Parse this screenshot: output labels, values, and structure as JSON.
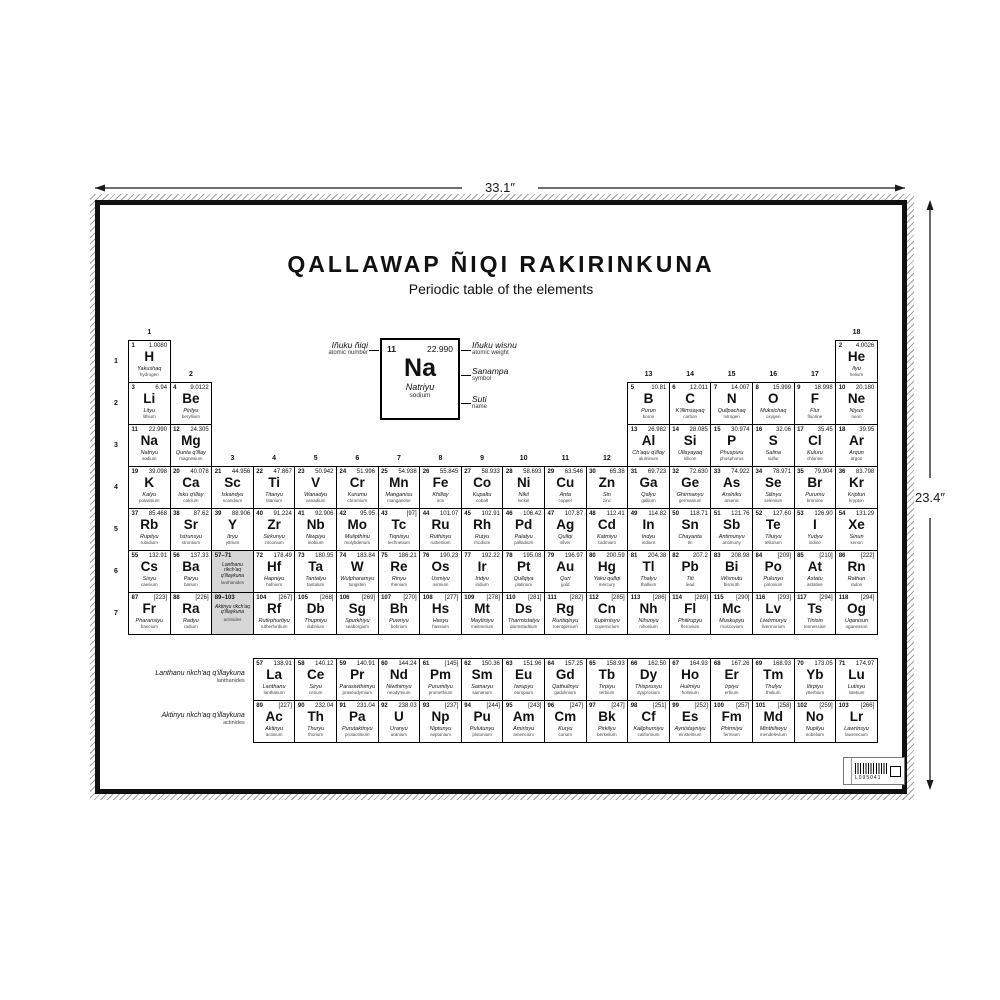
{
  "title": "QALLAWAP ÑIQI RAKIRINKUNA",
  "subtitle": "Periodic table of the elements",
  "dimensions": {
    "width": "33.1″",
    "height": "23.4″"
  },
  "legend": {
    "number": "11",
    "weight": "22.990",
    "symbol": "Na",
    "name": "Natriyu",
    "en": "sodium",
    "labels": {
      "number_qu": "Iñuku ñiqi",
      "number_en": "atomic number",
      "weight_qu": "Iñuku wisnu",
      "weight_en": "atomic weight",
      "symbol_qu": "Sanampa",
      "symbol_en": "symbol",
      "name_qu": "Suti",
      "name_en": "name"
    }
  },
  "table": {
    "period_labels": [
      "1",
      "2",
      "3",
      "4",
      "5",
      "6",
      "7"
    ],
    "group_labels": [
      {
        "t": "1",
        "c": 1,
        "p": 1
      },
      {
        "t": "18",
        "c": 18,
        "p": 1
      },
      {
        "t": "2",
        "c": 2,
        "p": 2
      },
      {
        "t": "13",
        "c": 13,
        "p": 2
      },
      {
        "t": "14",
        "c": 14,
        "p": 2
      },
      {
        "t": "15",
        "c": 15,
        "p": 2
      },
      {
        "t": "16",
        "c": 16,
        "p": 2
      },
      {
        "t": "17",
        "c": 17,
        "p": 2
      },
      {
        "t": "3",
        "c": 3,
        "p": 4
      },
      {
        "t": "4",
        "c": 4,
        "p": 4
      },
      {
        "t": "5",
        "c": 5,
        "p": 4
      },
      {
        "t": "6",
        "c": 6,
        "p": 4
      },
      {
        "t": "7",
        "c": 7,
        "p": 4
      },
      {
        "t": "8",
        "c": 8,
        "p": 4
      },
      {
        "t": "9",
        "c": 9,
        "p": 4
      },
      {
        "t": "10",
        "c": 10,
        "p": 4
      },
      {
        "t": "11",
        "c": 11,
        "p": 4
      },
      {
        "t": "12",
        "c": 12,
        "p": 4
      }
    ],
    "elements": [
      [
        1,
        "H",
        "1.0080",
        "Yakushaq",
        "hydrogen",
        1,
        1
      ],
      [
        2,
        "He",
        "4.0026",
        "Ilyu",
        "helium",
        1,
        18
      ],
      [
        3,
        "Li",
        "6.94",
        "Lityu",
        "lithium",
        2,
        1
      ],
      [
        4,
        "Be",
        "9.0122",
        "Pirilyu",
        "beryllium",
        2,
        2
      ],
      [
        5,
        "B",
        "10.81",
        "Purun",
        "boron",
        2,
        13
      ],
      [
        6,
        "C",
        "12.011",
        "K'illimsayaq",
        "carbon",
        2,
        14
      ],
      [
        7,
        "N",
        "14.007",
        "Qullpachaq",
        "nitrogen",
        2,
        15
      ],
      [
        8,
        "O",
        "15.999",
        "Muksichaq",
        "oxygen",
        2,
        16
      ],
      [
        9,
        "F",
        "18.998",
        "Flur",
        "fluorine",
        2,
        17
      ],
      [
        10,
        "Ne",
        "20.180",
        "Niyun",
        "neon",
        2,
        18
      ],
      [
        11,
        "Na",
        "22.990",
        "Natriyu",
        "sodium",
        3,
        1
      ],
      [
        12,
        "Mg",
        "24.305",
        "Qunta q'illay",
        "magnesium",
        3,
        2
      ],
      [
        13,
        "Al",
        "26.982",
        "Ch'aqu q'illay",
        "aluminum",
        3,
        13
      ],
      [
        14,
        "Si",
        "28.085",
        "Ullayayaq",
        "silicon",
        3,
        14
      ],
      [
        15,
        "P",
        "30.974",
        "Phuspuru",
        "phosphorus",
        3,
        15
      ],
      [
        16,
        "S",
        "32.06",
        "Salina",
        "sulfur",
        3,
        16
      ],
      [
        17,
        "Cl",
        "35.45",
        "Kuluru",
        "chlorine",
        3,
        17
      ],
      [
        18,
        "Ar",
        "39.95",
        "Arqun",
        "argon",
        3,
        18
      ],
      [
        19,
        "K",
        "39.098",
        "Kalyu",
        "potassium",
        4,
        1
      ],
      [
        20,
        "Ca",
        "40.078",
        "Isku q'illay",
        "calcium",
        4,
        2
      ],
      [
        21,
        "Sc",
        "44.956",
        "Iskandyu",
        "scandium",
        4,
        3
      ],
      [
        22,
        "Ti",
        "47.867",
        "Titanyu",
        "titanium",
        4,
        4
      ],
      [
        23,
        "V",
        "50.942",
        "Wanadyu",
        "vanadium",
        4,
        5
      ],
      [
        24,
        "Cr",
        "51.996",
        "Kurumu",
        "chromium",
        4,
        6
      ],
      [
        25,
        "Mn",
        "54.938",
        "Manganisu",
        "manganese",
        4,
        7
      ],
      [
        26,
        "Fe",
        "55.845",
        "Khillay",
        "iron",
        4,
        8
      ],
      [
        27,
        "Co",
        "58.933",
        "Kupaltu",
        "cobalt",
        4,
        9
      ],
      [
        28,
        "Ni",
        "58.693",
        "Nikil",
        "nickel",
        4,
        10
      ],
      [
        29,
        "Cu",
        "63.546",
        "Anta",
        "copper",
        4,
        11
      ],
      [
        30,
        "Zn",
        "65.38",
        "Sin",
        "zinc",
        4,
        12
      ],
      [
        31,
        "Ga",
        "69.723",
        "Qalyu",
        "gallium",
        4,
        13
      ],
      [
        32,
        "Ge",
        "72.630",
        "Ghirmanyu",
        "germanium",
        4,
        14
      ],
      [
        33,
        "As",
        "74.922",
        "Arsiniku",
        "arsenic",
        4,
        15
      ],
      [
        34,
        "Se",
        "78.971",
        "Silinyu",
        "selenium",
        4,
        16
      ],
      [
        35,
        "Br",
        "79.904",
        "Purumu",
        "bromine",
        4,
        17
      ],
      [
        36,
        "Kr",
        "83.798",
        "Kriptun",
        "krypton",
        4,
        18
      ],
      [
        37,
        "Rb",
        "85.468",
        "Rupityu",
        "rubidium",
        5,
        1
      ],
      [
        38,
        "Sr",
        "87.62",
        "Istrunsyu",
        "strontium",
        5,
        2
      ],
      [
        39,
        "Y",
        "88.906",
        "Itryu",
        "yttrium",
        5,
        3
      ],
      [
        40,
        "Zr",
        "91.224",
        "Sirkunyu",
        "zirconium",
        5,
        4
      ],
      [
        41,
        "Nb",
        "92.906",
        "Niwpiyu",
        "niobium",
        5,
        5
      ],
      [
        42,
        "Mo",
        "95.95",
        "Mulipthinu",
        "molybdenum",
        5,
        6
      ],
      [
        43,
        "Tc",
        "[97]",
        "Tiqnisyu",
        "technetium",
        5,
        7
      ],
      [
        44,
        "Ru",
        "101.07",
        "Ruthinyu",
        "ruthenium",
        5,
        8
      ],
      [
        45,
        "Rh",
        "102.91",
        "Rutyu",
        "rhodium",
        5,
        9
      ],
      [
        46,
        "Pd",
        "106.42",
        "Palatyu",
        "palladium",
        5,
        10
      ],
      [
        47,
        "Ag",
        "107.87",
        "Qullqi",
        "silver",
        5,
        11
      ],
      [
        48,
        "Cd",
        "112.41",
        "Katmiyu",
        "cadmium",
        5,
        12
      ],
      [
        49,
        "In",
        "114.82",
        "Indyu",
        "indium",
        5,
        13
      ],
      [
        50,
        "Sn",
        "118.71",
        "Chayanta",
        "tin",
        5,
        14
      ],
      [
        51,
        "Sb",
        "121.76",
        "Antimunyu",
        "antimony",
        5,
        15
      ],
      [
        52,
        "Te",
        "127.60",
        "Tiluryu",
        "tellurium",
        5,
        16
      ],
      [
        53,
        "I",
        "126.90",
        "Yudyu",
        "iodine",
        5,
        17
      ],
      [
        54,
        "Xe",
        "131.29",
        "Sinun",
        "xenon",
        5,
        18
      ],
      [
        55,
        "Cs",
        "132.91",
        "Sisyu",
        "caesium",
        6,
        1
      ],
      [
        56,
        "Ba",
        "137.33",
        "Paryu",
        "barium",
        6,
        2
      ],
      [
        72,
        "Hf",
        "178.49",
        "Hapniyu",
        "hafnium",
        6,
        4
      ],
      [
        73,
        "Ta",
        "180.95",
        "Tantalyu",
        "tantalum",
        6,
        5
      ],
      [
        74,
        "W",
        "183.84",
        "Wulpharamyu",
        "tungsten",
        6,
        6
      ],
      [
        75,
        "Re",
        "186.21",
        "Rinyu",
        "rhenium",
        6,
        7
      ],
      [
        76,
        "Os",
        "190.23",
        "Usmiyu",
        "osmium",
        6,
        8
      ],
      [
        77,
        "Ir",
        "192.22",
        "Iridyu",
        "iridium",
        6,
        9
      ],
      [
        78,
        "Pt",
        "195.08",
        "Qullqiya",
        "platinum",
        6,
        10
      ],
      [
        79,
        "Au",
        "196.97",
        "Quri",
        "gold",
        6,
        11
      ],
      [
        80,
        "Hg",
        "200.59",
        "Yaku qullqi",
        "mercury",
        6,
        12
      ],
      [
        81,
        "Tl",
        "204.38",
        "Thalyu",
        "thallium",
        6,
        13
      ],
      [
        82,
        "Pb",
        "207.2",
        "Titi",
        "lead",
        6,
        14
      ],
      [
        83,
        "Bi",
        "208.98",
        "Wismutu",
        "bismuth",
        6,
        15
      ],
      [
        84,
        "Po",
        "[209]",
        "Pulunyu",
        "polonium",
        6,
        16
      ],
      [
        85,
        "At",
        "[210]",
        "Astatu",
        "astatine",
        6,
        17
      ],
      [
        86,
        "Rn",
        "[222]",
        "Rathun",
        "radon",
        6,
        18
      ],
      [
        87,
        "Fr",
        "[223]",
        "Pharansiyu",
        "francium",
        7,
        1
      ],
      [
        88,
        "Ra",
        "[226]",
        "Radyu",
        "radium",
        7,
        2
      ],
      [
        104,
        "Rf",
        "[267]",
        "Rutirphurtiyu",
        "rutherfordium",
        7,
        4
      ],
      [
        105,
        "Db",
        "[268]",
        "Thupniyu",
        "dubnium",
        7,
        5
      ],
      [
        106,
        "Sg",
        "[269]",
        "Spurkhiyu",
        "seaborgium",
        7,
        6
      ],
      [
        107,
        "Bh",
        "[270]",
        "Puwriyu",
        "bohrium",
        7,
        7
      ],
      [
        108,
        "Hs",
        "[277]",
        "Hasyu",
        "hassium",
        7,
        8
      ],
      [
        109,
        "Mt",
        "[278]",
        "Maytiniyu",
        "meitnerium",
        7,
        9
      ],
      [
        110,
        "Ds",
        "[281]",
        "Tharmistatyu",
        "darmstadtium",
        7,
        10
      ],
      [
        111,
        "Rg",
        "[282]",
        "Runtiqinyu",
        "roentgenium",
        7,
        11
      ],
      [
        112,
        "Cn",
        "[285]",
        "Kupirnisyu",
        "copernicium",
        7,
        12
      ],
      [
        113,
        "Nh",
        "[286]",
        "Nihunyu",
        "nihonium",
        7,
        13
      ],
      [
        114,
        "Fl",
        "[289]",
        "Philirupyu",
        "flerovium",
        7,
        14
      ],
      [
        115,
        "Mc",
        "[290]",
        "Muskupyu",
        "moscovium",
        7,
        15
      ],
      [
        116,
        "Lv",
        "[293]",
        "Liwirmuryu",
        "livermorium",
        7,
        16
      ],
      [
        117,
        "Ts",
        "[294]",
        "Tinisin",
        "tennessine",
        7,
        17
      ],
      [
        118,
        "Og",
        "[294]",
        "Uqanisun",
        "oganesson",
        7,
        18
      ]
    ],
    "f_elements": [
      [
        57,
        "La",
        "138.91",
        "Lanthanu",
        "lanthanum",
        1,
        1
      ],
      [
        58,
        "Ce",
        "140.12",
        "Siryu",
        "cerium",
        1,
        2
      ],
      [
        59,
        "Pr",
        "140.91",
        "Parasiwthimyu",
        "praseodymium",
        1,
        3
      ],
      [
        60,
        "Nd",
        "144.24",
        "Niwthimyu",
        "neodymium",
        1,
        4
      ],
      [
        61,
        "Pm",
        "[145]",
        "Purumityu",
        "promethium",
        1,
        5
      ],
      [
        62,
        "Sm",
        "150.36",
        "Samaryu",
        "samarium",
        1,
        6
      ],
      [
        63,
        "Eu",
        "151.96",
        "Iwrupyu",
        "europium",
        1,
        7
      ],
      [
        64,
        "Gd",
        "157.25",
        "Qathulinyu",
        "gadolinium",
        1,
        8
      ],
      [
        65,
        "Tb",
        "158.93",
        "Tirpiyu",
        "terbium",
        1,
        9
      ],
      [
        66,
        "Dy",
        "162.50",
        "Thisprusyu",
        "dysprosium",
        1,
        10
      ],
      [
        67,
        "Ho",
        "164.93",
        "Hulmiyu",
        "holmium",
        1,
        11
      ],
      [
        68,
        "Er",
        "167.26",
        "Irpiyu",
        "erbium",
        1,
        12
      ],
      [
        69,
        "Tm",
        "168.93",
        "Thulyu",
        "thulium",
        1,
        13
      ],
      [
        70,
        "Yb",
        "173.05",
        "Itirpiyu",
        "ytterbium",
        1,
        14
      ],
      [
        71,
        "Lu",
        "174.97",
        "Lutisyu",
        "lutetium",
        1,
        15
      ],
      [
        89,
        "Ac",
        "[227]",
        "Aktinyu",
        "actinium",
        2,
        1
      ],
      [
        90,
        "Th",
        "232.04",
        "Thuryu",
        "thorium",
        2,
        2
      ],
      [
        91,
        "Pa",
        "231.04",
        "Purutaktinyu",
        "protactinium",
        2,
        3
      ],
      [
        92,
        "U",
        "238.03",
        "Uranyu",
        "uranium",
        2,
        4
      ],
      [
        93,
        "Np",
        "[237]",
        "Niptunyu",
        "neptunium",
        2,
        5
      ],
      [
        94,
        "Pu",
        "[244]",
        "Pulutunyu",
        "plutonium",
        2,
        6
      ],
      [
        95,
        "Am",
        "[243]",
        "Amirisyu",
        "americium",
        2,
        7
      ],
      [
        96,
        "Cm",
        "[247]",
        "Kuryu",
        "curium",
        2,
        8
      ],
      [
        97,
        "Bk",
        "[247]",
        "Pirkilyu",
        "berkelium",
        2,
        9
      ],
      [
        98,
        "Cf",
        "[251]",
        "Kaliphurniyu",
        "californium",
        2,
        10
      ],
      [
        99,
        "Es",
        "[252]",
        "Aynistayniyu",
        "einsteinium",
        2,
        11
      ],
      [
        100,
        "Fm",
        "[257]",
        "Phirmiyu",
        "fermium",
        2,
        12
      ],
      [
        101,
        "Md",
        "[258]",
        "Minthiliwyu",
        "mendelevium",
        2,
        13
      ],
      [
        102,
        "No",
        "[259]",
        "Nupilyu",
        "nobelium",
        2,
        14
      ],
      [
        103,
        "Lr",
        "[266]",
        "Lawrinsyu",
        "lawrencium",
        2,
        15
      ]
    ],
    "placeholders": [
      {
        "range": "57–71",
        "qu": "Lanthanu rikch'aq q'illaykuna",
        "en": "lanthanides",
        "p": 6,
        "c": 3
      },
      {
        "range": "89–103",
        "qu": "Aktinyu rikch'aq q'illaykuna",
        "en": "actinides",
        "p": 7,
        "c": 3
      }
    ],
    "f_row_labels": [
      {
        "qu": "Lanthanu rikch'aq q'illaykuna",
        "en": "lanthanides"
      },
      {
        "qu": "Aktinyu rikch'aq q'illaykuna",
        "en": "actinides"
      }
    ]
  },
  "barcode": {
    "code": "L095041"
  }
}
